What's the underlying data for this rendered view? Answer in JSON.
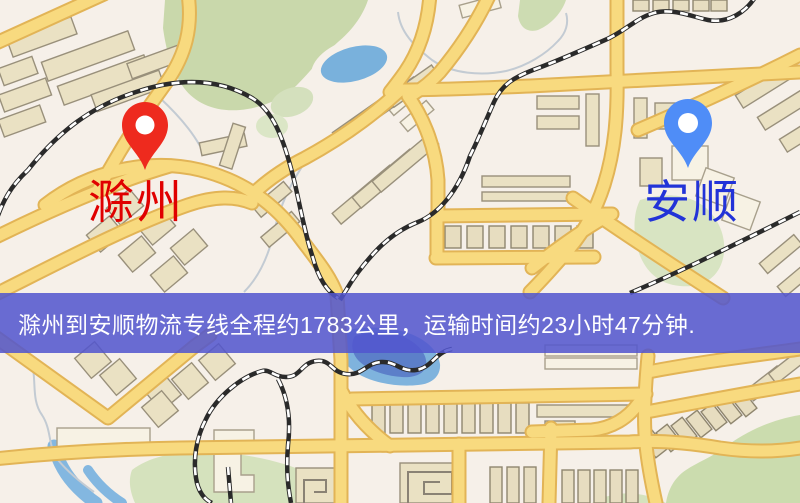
{
  "map": {
    "markers": [
      {
        "id": "origin",
        "label": "滁州",
        "pin_color": "#ee2a1e",
        "label_color": "#e00000"
      },
      {
        "id": "destination",
        "label": "安顺",
        "pin_color": "#4f8df7",
        "label_color": "#2233d8"
      }
    ],
    "route": {
      "origin": "滁州",
      "destination": "安顺",
      "distance_km": 1783,
      "duration": "23小时47分钟"
    },
    "banner": {
      "text": "滁州到安顺物流专线全程约1783公里，运输时间约23小时47分钟.",
      "background_css": "rgba(82,85,206,0.86)",
      "text_color": "#ffffff"
    },
    "palette": {
      "background": "#f6f0e9",
      "road": "#f8da7f",
      "road_casing": "#e2b456",
      "building": "#eae1c3",
      "green_area": "#c9d8ab",
      "water": "#79b1dc",
      "railway": "#2a2a2a"
    }
  }
}
